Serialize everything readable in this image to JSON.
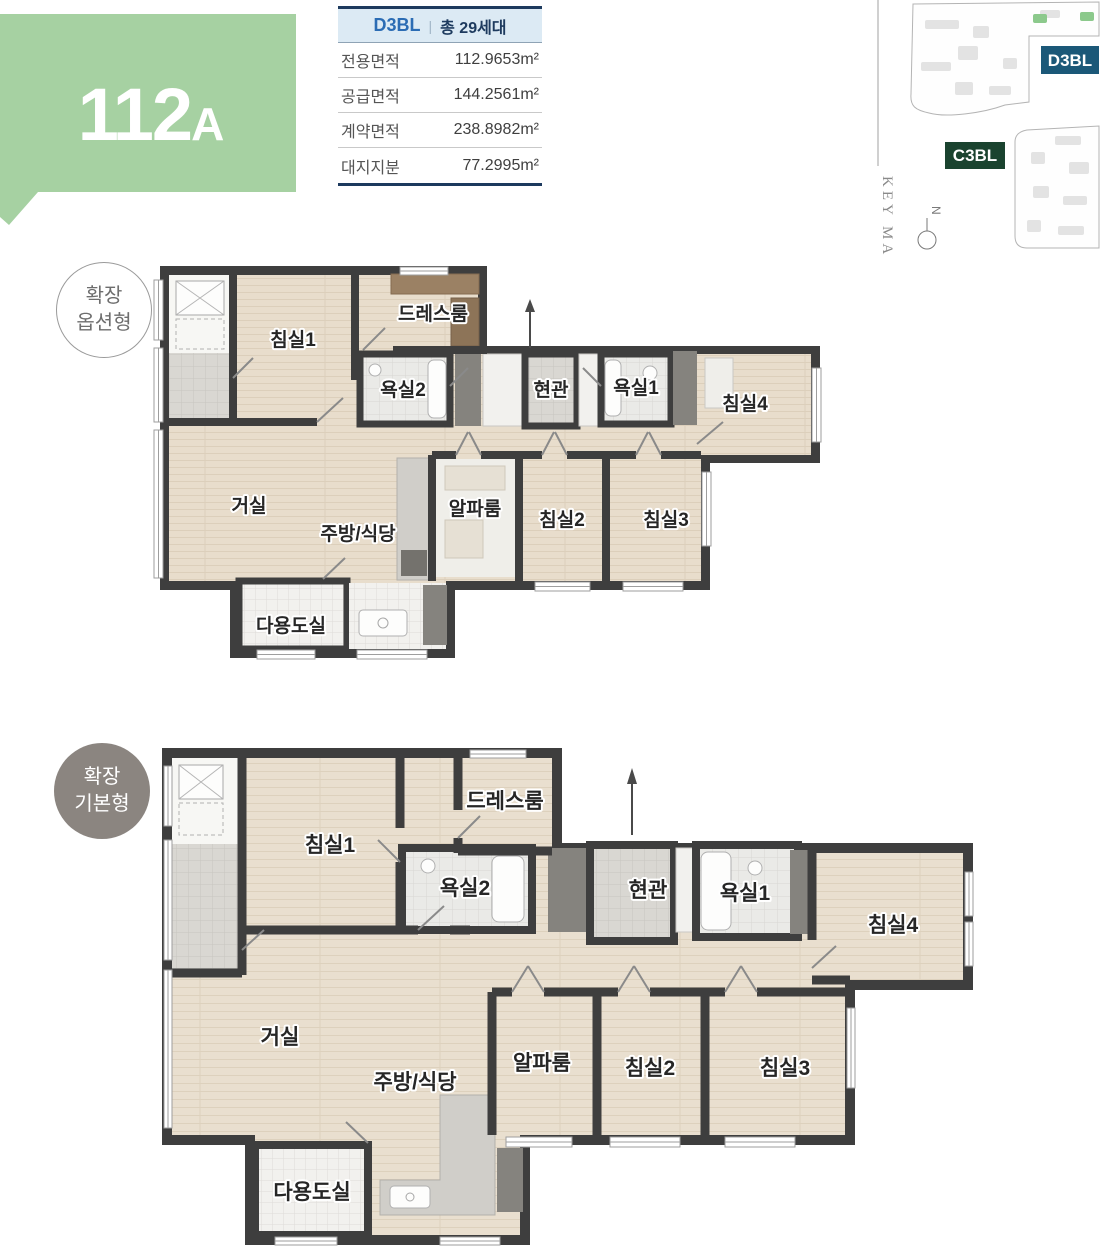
{
  "unit_badge": {
    "number": "112",
    "suffix": "A"
  },
  "info_table": {
    "block": "D3BL",
    "divider": "|",
    "total_units": "총 29세대",
    "rows": [
      {
        "label": "전용면적",
        "value": "112.9653m²"
      },
      {
        "label": "공급면적",
        "value": "144.2561m²"
      },
      {
        "label": "계약면적",
        "value": "238.8982m²"
      },
      {
        "label": "대지지분",
        "value": "77.2995m²"
      }
    ]
  },
  "key_map": {
    "title": "KEY MAP",
    "north_label": "N",
    "block_d": "D3BL",
    "block_c": "C3BL"
  },
  "plans": [
    {
      "badge_line1": "확장",
      "badge_line2": "옵션형",
      "rooms": {
        "bedroom1": "침실1",
        "dressroom": "드레스룸",
        "bath2": "욕실2",
        "entrance": "현관",
        "bath1": "욕실1",
        "bedroom4": "침실4",
        "living": "거실",
        "kitchen": "주방/식당",
        "alpha": "알파룸",
        "bedroom2": "침실2",
        "bedroom3": "침실3",
        "utility": "다용도실"
      }
    },
    {
      "badge_line1": "확장",
      "badge_line2": "기본형",
      "rooms": {
        "bedroom1": "침실1",
        "dressroom": "드레스룸",
        "bath2": "욕실2",
        "entrance": "현관",
        "bath1": "욕실1",
        "bedroom4": "침실4",
        "living": "거실",
        "kitchen": "주방/식당",
        "alpha": "알파룸",
        "bedroom2": "침실2",
        "bedroom3": "침실3",
        "utility": "다용도실"
      }
    }
  ],
  "colors": {
    "badge_green": "#a6d1a2",
    "circle_gray": "#8b8580",
    "table_navy": "#1d3a5e",
    "table_blue": "#2b6cb4",
    "table_header_bg": "#dceaf4",
    "map_block_d_bg": "#1b5878",
    "map_block_c_bg": "#1a432f",
    "map_green": "#8cc98c",
    "wall": "#3e3e3e"
  }
}
